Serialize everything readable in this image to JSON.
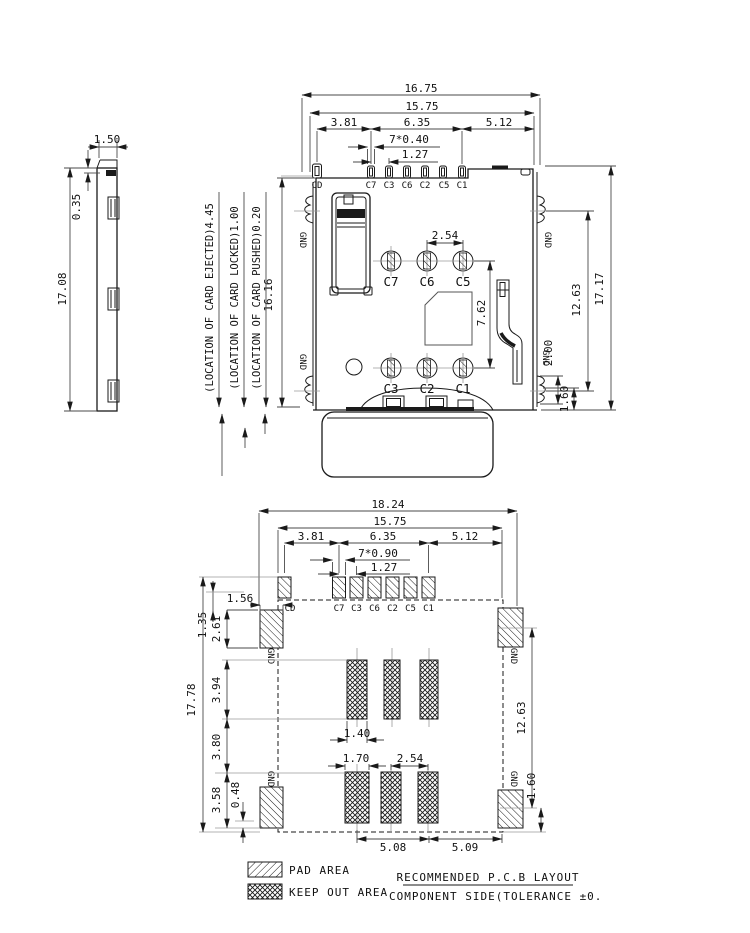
{
  "side_view": {
    "dims": {
      "tab_w": "1.50",
      "step_h": "0.35",
      "height": "17.08"
    }
  },
  "top_view": {
    "dims": {
      "overall_w": "16.75",
      "pins_w": "15.75",
      "cd_c7": "3.81",
      "c7_c1": "6.35",
      "right_w": "5.12",
      "pin_w": "7*0.40",
      "pitch": "1.27",
      "col_pitch": "2.54",
      "row_pitch": "7.62",
      "left_h": "16.16",
      "overall_h": "17.17",
      "gnd_span": "12.63",
      "gnd_h": "2.00",
      "bottom_h": "1.60"
    },
    "pins": [
      "CD",
      "C7",
      "C3",
      "C6",
      "C2",
      "C5",
      "C1"
    ],
    "contacts": [
      "C7",
      "C6",
      "C5",
      "C3",
      "C2",
      "C1"
    ],
    "annotations": [
      "(LOCATION OF CARD EJECTED)4.45",
      "(LOCATION OF CARD LOCKED)1.00",
      "(LOCATION OF CARD PUSHED)0.20"
    ],
    "gnd_label": "GND"
  },
  "pcb_view": {
    "dims": {
      "overall_w": "18.24",
      "court_w": "15.75",
      "cd_c7": "3.81",
      "c7_c1": "6.35",
      "right_w": "5.12",
      "pad_w": "7*0.90",
      "pitch": "1.27",
      "gnd_pad_w": "1.56",
      "offset": "1.35",
      "gnd_pad_h": "2.61",
      "height": "17.78",
      "ko_h1": "3.94",
      "ko_gap": "3.80",
      "ko_h2": "3.58",
      "bot_off": "0.48",
      "ko_w1": "1.40",
      "ko_w2": "1.70",
      "ko_pitch": "2.54",
      "span_l": "5.08",
      "span_r": "5.09",
      "gnd_span": "12.63",
      "bottom_h": "1.60"
    },
    "pads": [
      "CD",
      "C7",
      "C3",
      "C6",
      "C2",
      "C5",
      "C1"
    ],
    "gnd_label": "GND"
  },
  "legend": {
    "pad_area": "PAD AREA",
    "keep_out": "KEEP OUT AREA",
    "title": "RECOMMENDED P.C.B LAYOUT",
    "subtitle": "COMPONENT SIDE(TOLERANCE ±0."
  },
  "colors": {
    "line": "#1a1a1a",
    "background": "#ffffff"
  }
}
